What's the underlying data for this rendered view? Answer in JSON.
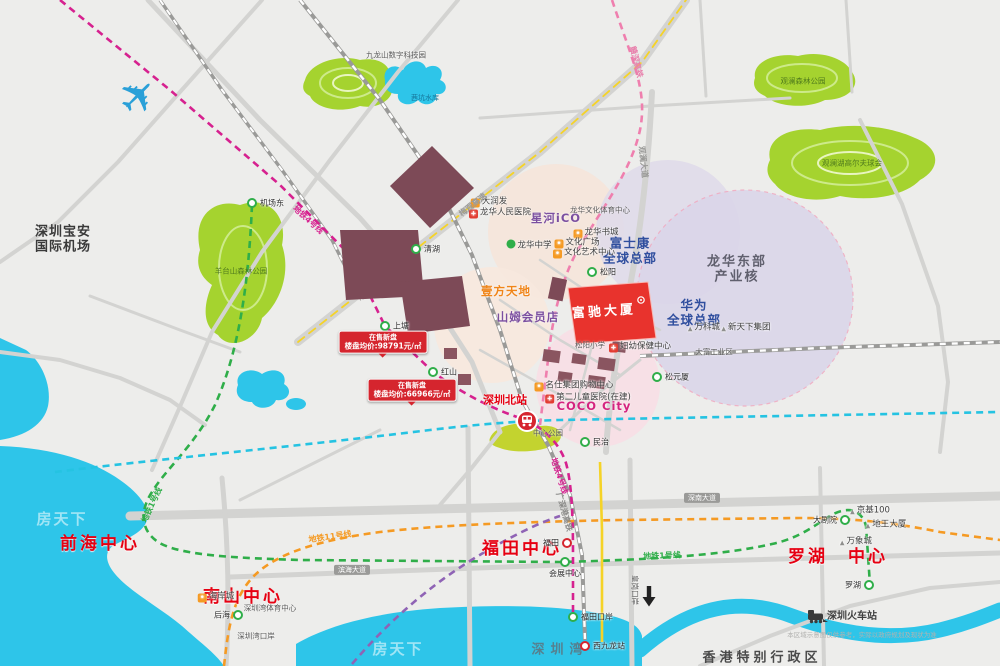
{
  "meta": {
    "title": "楼盘区位交通示意图",
    "colors": {
      "background": "#ededeb",
      "water": "#2ec5e9",
      "park": "#a5d32f",
      "accent_red": "#e60012",
      "corp_blue": "#2f4e9e",
      "metro_line1_green": "#2fae49",
      "metro_line4_magenta": "#d6218f",
      "metro_orange": "#f59a23",
      "metro_cyan": "#25c3e2",
      "hsr_pink": "#ef7fae",
      "renewal_block": "#7d4a57",
      "project_red": "#e8332d"
    }
  },
  "map": {
    "project": {
      "name": "富驰大厦"
    },
    "labels": [
      {
        "n": "label-qianhai-center",
        "t": "前海中心",
        "x": 100,
        "y": 544,
        "cls": "city"
      },
      {
        "n": "label-nanshan-center",
        "t": "南山中心",
        "x": 243,
        "y": 597,
        "cls": "city"
      },
      {
        "n": "label-futian-center",
        "t": "福田中心",
        "x": 522,
        "y": 549,
        "cls": "city"
      },
      {
        "n": "label-luohu-center",
        "t": "罗湖　中心",
        "x": 838,
        "y": 557,
        "cls": "city"
      },
      {
        "n": "label-foxconn-hq",
        "t": "富士康\n全球总部",
        "x": 630,
        "y": 251,
        "cls": "corp"
      },
      {
        "n": "label-huawei-hq",
        "t": "华为\n全球总部",
        "x": 694,
        "y": 313,
        "cls": "corp"
      },
      {
        "n": "label-longhua-east-industry",
        "t": "龙华东部\n产业核",
        "x": 737,
        "y": 270,
        "cls": "zone"
      },
      {
        "n": "label-airport",
        "t": "深圳宝安\n国际机场",
        "x": 63,
        "y": 240,
        "cls": "airport-label"
      },
      {
        "n": "label-hongkong-sar",
        "t": "香港特别行政区",
        "x": 762,
        "y": 658,
        "cls": "hk"
      },
      {
        "n": "label-shenzhen-bay",
        "t": "深圳湾",
        "x": 560,
        "y": 650,
        "cls": "water"
      },
      {
        "n": "label-shenzhen-railway-station",
        "t": "深圳火车站",
        "x": 852,
        "y": 617,
        "cls": "poi-bold"
      },
      {
        "n": "label-shenzhen-north-station",
        "t": "深圳北站",
        "x": 505,
        "y": 401,
        "cls": "red-bold"
      },
      {
        "n": "label-coco-city",
        "t": "COCO City",
        "x": 594,
        "y": 407,
        "cls": "mall",
        "col": "#d4237f"
      },
      {
        "n": "label-xinghe-ico",
        "t": "星河iCO",
        "x": 556,
        "y": 219,
        "cls": "mall",
        "col": "#7b4fa0"
      },
      {
        "n": "label-yifang-tiandi",
        "t": "壹方天地",
        "x": 506,
        "y": 292,
        "cls": "mall",
        "col": "#f08519"
      },
      {
        "n": "label-sams-club",
        "t": "山姆会员店",
        "x": 528,
        "y": 318,
        "cls": "mall",
        "col": "#7b4fa0"
      },
      {
        "n": "label-fuchi-building",
        "t": "富驰大厦",
        "x": 604,
        "y": 312,
        "cls": "building",
        "rot": -4
      },
      {
        "n": "poi-longhua-peoples-hospital",
        "t": "龙华人民医院",
        "x": 500,
        "y": 213,
        "icon": "red",
        "cls": "poi"
      },
      {
        "n": "poi-darunfa",
        "t": "大润发",
        "x": 489,
        "y": 202,
        "icon": "orange",
        "cls": "poi"
      },
      {
        "n": "poi-longhua-middle-school",
        "t": "龙华中学",
        "x": 529,
        "y": 245,
        "icon": "green",
        "cls": "poi"
      },
      {
        "n": "poi-longhua-book-city",
        "t": "龙华书城",
        "x": 596,
        "y": 233,
        "icon": "orange",
        "cls": "poi"
      },
      {
        "n": "poi-culture-square",
        "t": "文化广场",
        "x": 577,
        "y": 243,
        "icon": "orange",
        "cls": "poi"
      },
      {
        "n": "poi-culture-art-center",
        "t": "文化艺术中心",
        "x": 584,
        "y": 253,
        "icon": "orange",
        "cls": "poi"
      },
      {
        "n": "poi-longhua-culture-sports-center",
        "t": "龙华文化体育中心",
        "x": 600,
        "y": 211,
        "cls": "tiny"
      },
      {
        "n": "poi-songyang-primary-school",
        "t": "松阳小学",
        "x": 590,
        "y": 346,
        "cls": "tiny"
      },
      {
        "n": "poi-fuyou-center",
        "t": "妇幼保健中心",
        "x": 640,
        "y": 347,
        "icon": "red",
        "cls": "poi"
      },
      {
        "n": "poi-mingshi-mall",
        "t": "名仕集团购物中心",
        "x": 574,
        "y": 386,
        "icon": "orange",
        "cls": "poi"
      },
      {
        "n": "poi-second-children-hospital",
        "t": "第二儿童医院(在建)",
        "x": 588,
        "y": 398,
        "icon": "red",
        "cls": "poi"
      },
      {
        "n": "poi-center-park",
        "t": "中心公园",
        "x": 548,
        "y": 434,
        "cls": "tiny"
      },
      {
        "n": "poi-haianchen",
        "t": "海岸城",
        "x": 216,
        "y": 597,
        "icon": "orange",
        "cls": "poi"
      },
      {
        "n": "poi-shenzhen-bay-sports-center",
        "t": "深圳湾体育中心",
        "x": 270,
        "y": 609,
        "cls": "tiny"
      },
      {
        "n": "poi-shenzhen-bay-port",
        "t": "深圳湾口岸",
        "x": 256,
        "y": 637,
        "cls": "tiny"
      },
      {
        "n": "poi-kingkey100",
        "t": "京基100",
        "x": 870,
        "y": 511,
        "icon": "tri",
        "cls": "poi"
      },
      {
        "n": "poi-diwang-building",
        "t": "地王大厦",
        "x": 886,
        "y": 525,
        "icon": "tri",
        "cls": "poi"
      },
      {
        "n": "poi-mixc",
        "t": "万象城",
        "x": 856,
        "y": 542,
        "icon": "tri",
        "cls": "poi"
      },
      {
        "n": "poi-vanke-city",
        "t": "万科城",
        "x": 704,
        "y": 328,
        "icon": "tri",
        "cls": "poi"
      },
      {
        "n": "poi-xintianxia-group",
        "t": "新天下集团",
        "x": 746,
        "y": 328,
        "icon": "tri",
        "cls": "poi"
      },
      {
        "n": "poi-dafu-industrial",
        "t": "大富工业区",
        "x": 714,
        "y": 353,
        "cls": "tiny"
      },
      {
        "n": "poi-jiulongshan-tech-park",
        "t": "九龙山数字科技园",
        "x": 396,
        "y": 56,
        "cls": "tiny"
      },
      {
        "n": "poi-qiankeng-reservoir",
        "t": "茜坑水库",
        "x": 425,
        "y": 98,
        "cls": "tiny2"
      },
      {
        "n": "poi-guanlan-forest-park",
        "t": "观澜森林公园",
        "x": 803,
        "y": 82,
        "cls": "park"
      },
      {
        "n": "poi-mission-hills-golf",
        "t": "观澜湖高尔夫球会",
        "x": 852,
        "y": 164,
        "cls": "park"
      },
      {
        "n": "poi-yangtaishan-forest-park",
        "t": "羊台山森林公园",
        "x": 241,
        "y": 272,
        "cls": "park"
      },
      {
        "n": "poi-huanggang-port",
        "t": "皇岗口岸",
        "x": 634,
        "y": 590,
        "cls": "tiny",
        "rot": 90
      },
      {
        "n": "line-label-metro1-west",
        "t": "地铁1号线",
        "x": 152,
        "y": 505,
        "cls": "line",
        "col": "#2fae49",
        "rot": -65
      },
      {
        "n": "line-label-metro1-east",
        "t": "地铁1号线",
        "x": 662,
        "y": 556,
        "cls": "line",
        "col": "#2fae49",
        "rot": -2
      },
      {
        "n": "line-label-metro4-north",
        "t": "地铁4号线",
        "x": 308,
        "y": 220,
        "cls": "line",
        "col": "#d6218f",
        "rot": 42
      },
      {
        "n": "line-label-metro4-south",
        "t": "地铁4号线",
        "x": 559,
        "y": 476,
        "cls": "line",
        "col": "#d6218f",
        "rot": 72
      },
      {
        "n": "line-label-metro11",
        "t": "地铁11号线",
        "x": 330,
        "y": 537,
        "cls": "line",
        "col": "#f59a23",
        "rot": -8
      },
      {
        "n": "line-label-ganshen-hsr",
        "t": "赣深高铁",
        "x": 636,
        "y": 62,
        "cls": "line",
        "col": "#e87fab",
        "rot": 76
      },
      {
        "n": "line-label-gsg-hsr",
        "t": "广深港高铁",
        "x": 564,
        "y": 512,
        "cls": "line",
        "col": "#8a8a88",
        "rot": 74
      },
      {
        "n": "line-label-meiguan-expwy",
        "t": "梅观高速",
        "x": 473,
        "y": 205,
        "cls": "line",
        "col": "#9a9a98",
        "rot": -38
      },
      {
        "n": "line-label-guanlan-avenue",
        "t": "观澜大道",
        "x": 643,
        "y": 162,
        "cls": "line",
        "col": "#9a9a98",
        "rot": 84
      },
      {
        "n": "road-plate-shennan-avenue",
        "t": "深南大道",
        "x": 702,
        "y": 498,
        "cls": "plate"
      },
      {
        "n": "road-plate-binhai-avenue",
        "t": "滨海大道",
        "x": 352,
        "y": 570,
        "cls": "plate"
      },
      {
        "n": "watermark-left",
        "t": "房天下",
        "x": 62,
        "y": 520,
        "cls": "wm"
      },
      {
        "n": "watermark-bay",
        "t": "房天下",
        "x": 398,
        "y": 650,
        "cls": "wm"
      },
      {
        "n": "map-disclaimer",
        "t": "本区域示意图仅供参考，实际以政府规划及现状为准",
        "x": 862,
        "y": 636,
        "cls": "disc"
      }
    ],
    "stations": [
      {
        "t": "机场东",
        "x": 252,
        "y": 203,
        "side": "right"
      },
      {
        "t": "清湖",
        "x": 416,
        "y": 249,
        "side": "right"
      },
      {
        "t": "上塘",
        "x": 385,
        "y": 326,
        "side": "right"
      },
      {
        "t": "红山",
        "x": 433,
        "y": 372,
        "side": "right"
      },
      {
        "t": "松阳",
        "x": 592,
        "y": 272,
        "side": "right"
      },
      {
        "t": "民治",
        "x": 585,
        "y": 442,
        "side": "right"
      },
      {
        "t": "松元厦",
        "x": 657,
        "y": 377,
        "side": "right"
      },
      {
        "t": "会展中心",
        "x": 565,
        "y": 562,
        "side": "below"
      },
      {
        "t": "福田",
        "x": 567,
        "y": 543,
        "side": "left",
        "ring": "red"
      },
      {
        "t": "福田口岸",
        "x": 573,
        "y": 617,
        "side": "right"
      },
      {
        "t": "罗湖",
        "x": 869,
        "y": 585,
        "side": "left"
      },
      {
        "t": "大剧院",
        "x": 845,
        "y": 520,
        "side": "left"
      },
      {
        "t": "后海",
        "x": 238,
        "y": 615,
        "side": "left"
      },
      {
        "t": "西九龙站",
        "x": 585,
        "y": 646,
        "side": "right",
        "ring": "red"
      }
    ],
    "price_tags": [
      {
        "x": 383,
        "y": 354,
        "l1": "在售新盘",
        "l2": "楼盘均价:98791元/㎡"
      },
      {
        "x": 412,
        "y": 402,
        "l1": "在售新盘",
        "l2": "楼盘均价:66966元/㎡"
      }
    ]
  }
}
